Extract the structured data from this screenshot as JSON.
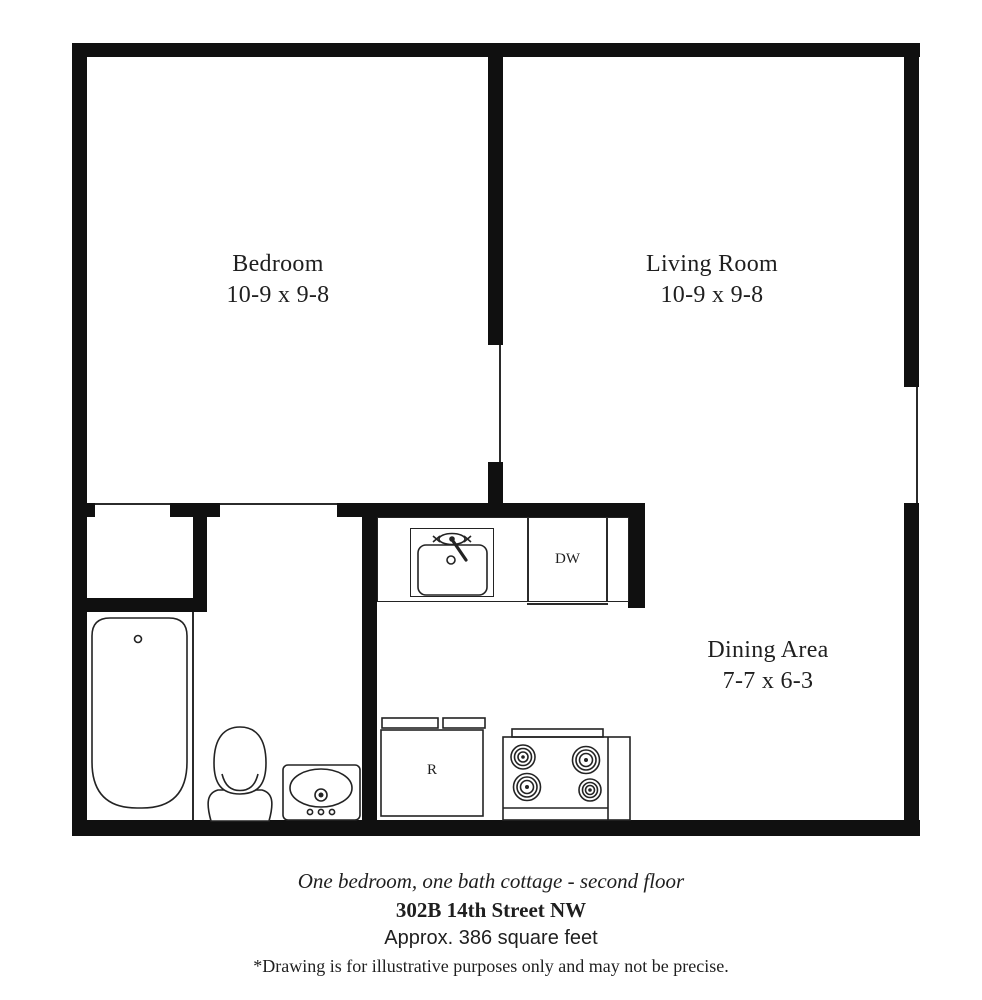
{
  "plan": {
    "rooms": [
      {
        "name": "Bedroom",
        "dims": "10-9 x 9-8"
      },
      {
        "name": "Living Room",
        "dims": "10-9 x 9-8"
      },
      {
        "name": "Dining Area",
        "dims": "7-7 x 6-3"
      }
    ],
    "appliances": {
      "dishwasher": "DW",
      "refrigerator": "R"
    }
  },
  "caption": {
    "line1": "One bedroom, one bath cottage - second floor",
    "line2": "302B 14th Street NW",
    "line3": "Approx. 386 square feet",
    "line4": "*Drawing is for illustrative purposes only and may not be precise."
  },
  "colors": {
    "wall": "#101010",
    "thin_line": "#2b2b2b",
    "background": "#ffffff",
    "text": "#1f1f1f"
  }
}
